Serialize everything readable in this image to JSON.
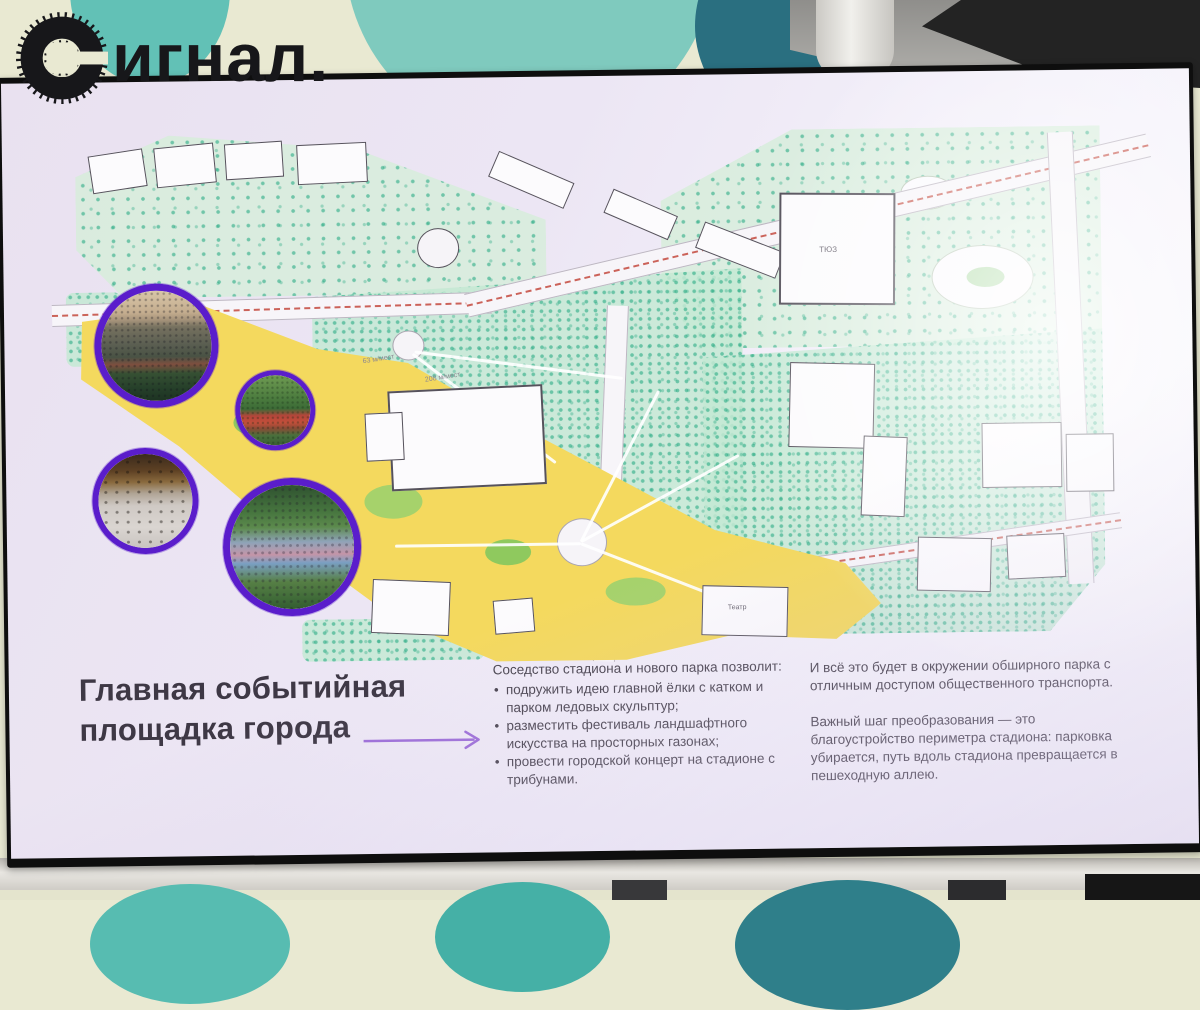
{
  "logo": {
    "text": "Сигнал.",
    "text_after_icon": "игнал."
  },
  "slide": {
    "title": {
      "line1": "Главная событийная",
      "line2": "площадка города"
    },
    "intro": "Соседство стадиона и нового парка позволит:",
    "bullets": [
      "подружить идею главной ёлки с катком и парком ледовых скульптур;",
      "разместить фестиваль ландшафтного искусства на просторных газонах;",
      "провести городской концерт на стадионе с трибунами."
    ],
    "right_paragraphs": [
      "И всё это будет в окружении обширного парка с отличным доступом общественного транспорта.",
      "Важный шаг преобразования — это благоустройство периметра стадиона: парковка убирается, путь вдоль стадиона превращается в пешеходную аллею."
    ],
    "map_labels": [
      {
        "text": "ТЮЗ"
      },
      {
        "text": "Театр"
      },
      {
        "text": "208 м/мест"
      },
      {
        "text": "63 м/мест"
      }
    ]
  },
  "colors": {
    "accent_purple_ring": "#5a1dcb",
    "arrow_purple": "#9d6ed8",
    "map_event_zone_yellow": "#f4d95e",
    "map_park_green": "#c4e9d4",
    "map_red_dashed_route": "#c4493e",
    "wall_teal_light": "#57bcb1",
    "wall_teal_dark": "#2f7f8a",
    "wall_cream": "#e9e9d2",
    "logo_black": "#17171a"
  }
}
